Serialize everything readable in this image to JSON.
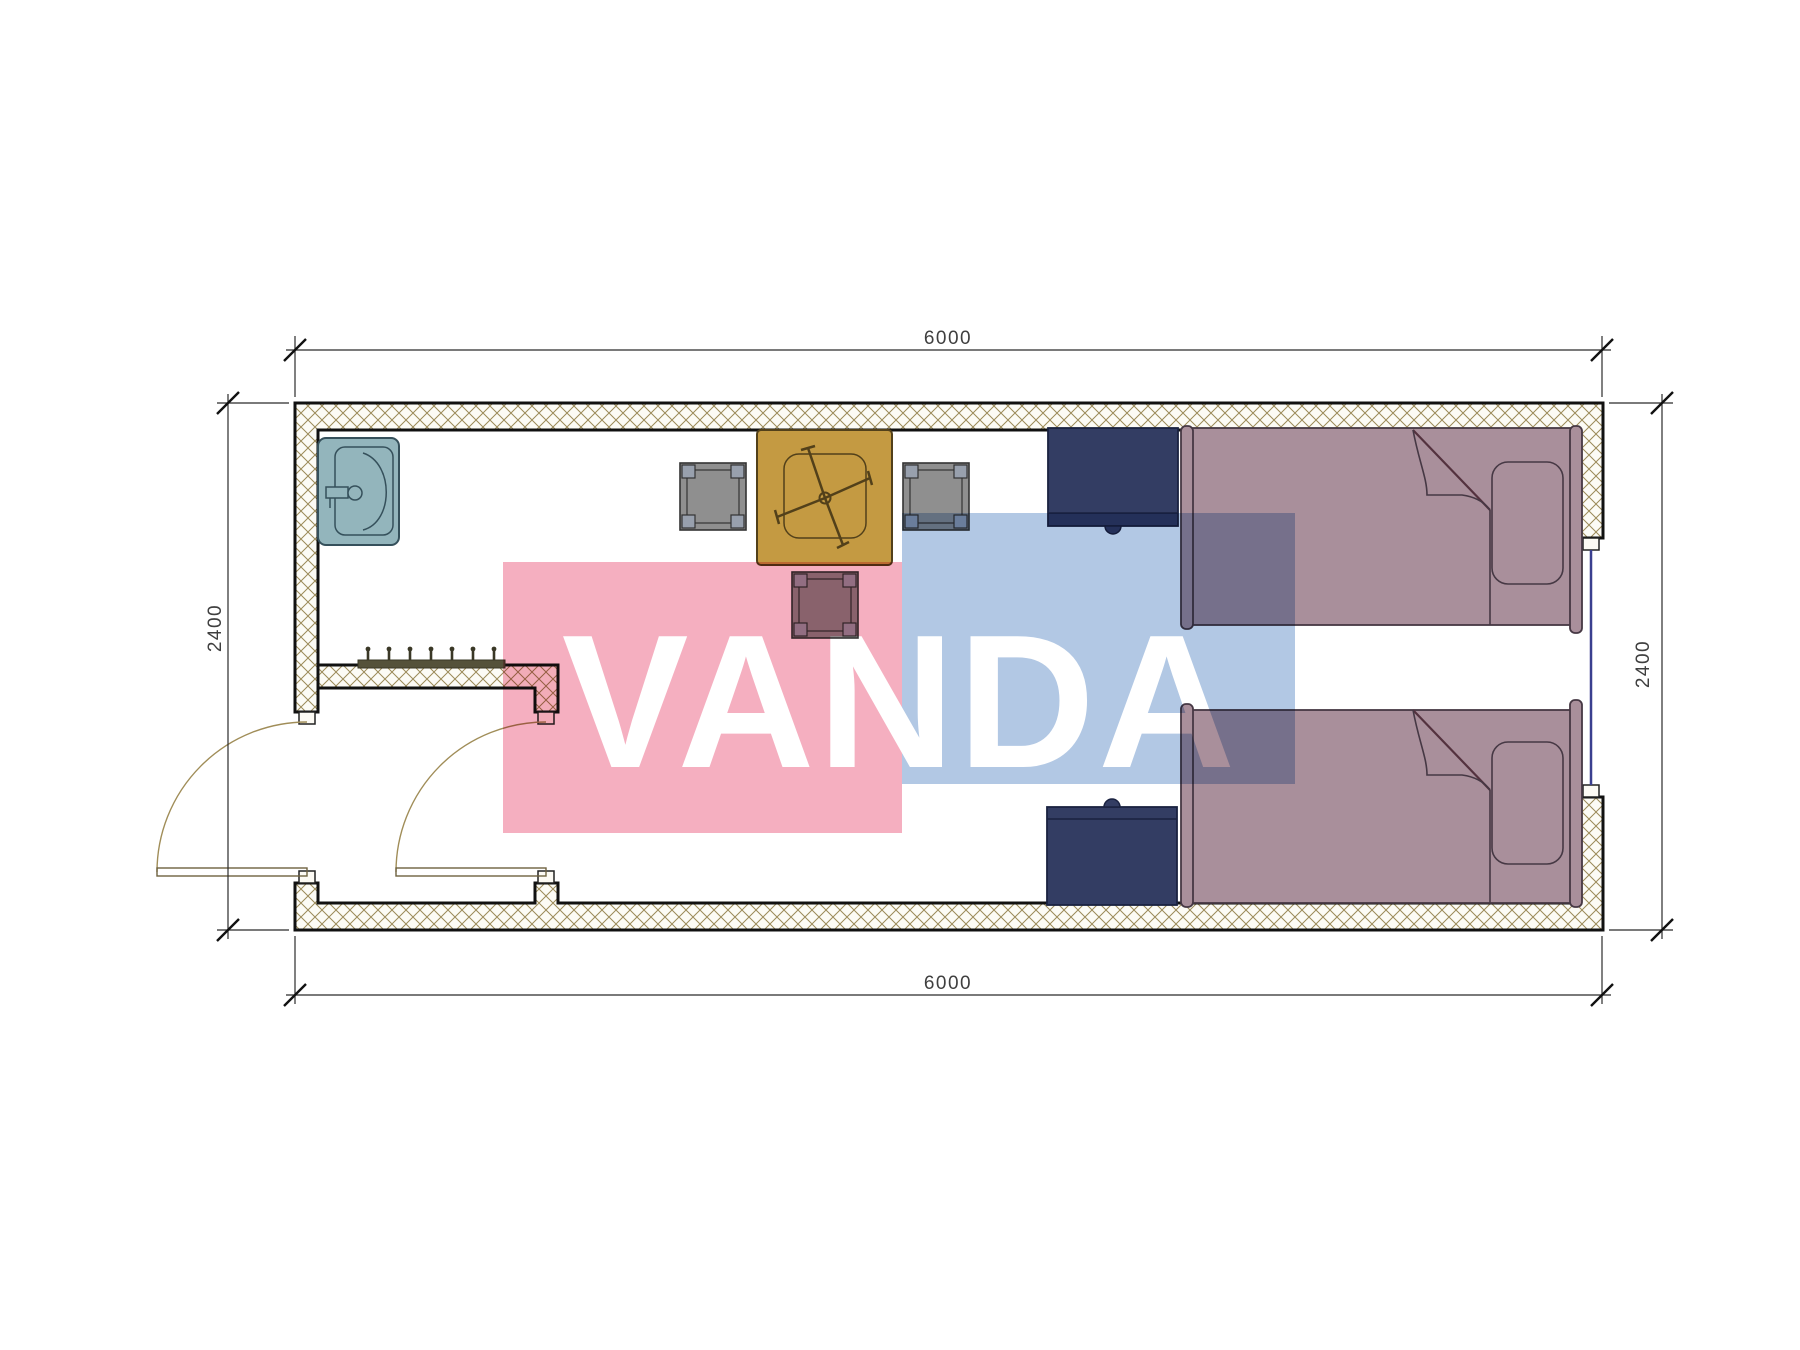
{
  "drawing": {
    "type": "floor-plan",
    "room": "container cabin with two beds",
    "width_label": "6000",
    "depth_label": "2400"
  },
  "dimensions": {
    "top": "6000",
    "bottom": "6000",
    "left": "2400",
    "right": "2400"
  },
  "watermark": {
    "text": "VANDA",
    "pink": "#f5afc0",
    "blue": "#b2c8e4"
  },
  "colors": {
    "wall_fill": "#fcfbf5",
    "wall_hatch": "#9b8a58",
    "outline": "#111111",
    "sink": "#93b5bc",
    "sink_stroke": "#35505b",
    "table": "#c49a42",
    "table_stroke": "#52401a",
    "chair": "#8f8f8f",
    "chair_foot": "#98a0ad",
    "chair_stroke": "#333333",
    "bed": "#a98f9b",
    "bed_stroke": "#463844",
    "bed_fold": "#54323f",
    "nightstand": "#333d63",
    "nightstand_stroke": "#1a2240",
    "window_glass": "#3a3f8f",
    "door": "#a08d58",
    "door_leaf": "#6e6240",
    "coat_rack": "#55523a",
    "jamb_fill": "#fcfaf4",
    "dim_line": "#2b2b2b",
    "dim_text": "#3f3f3f"
  },
  "legend": {
    "items": [
      "sink",
      "coat-rack",
      "entry-door",
      "interior-door",
      "table",
      "chair",
      "bed",
      "nightstand",
      "window"
    ]
  }
}
